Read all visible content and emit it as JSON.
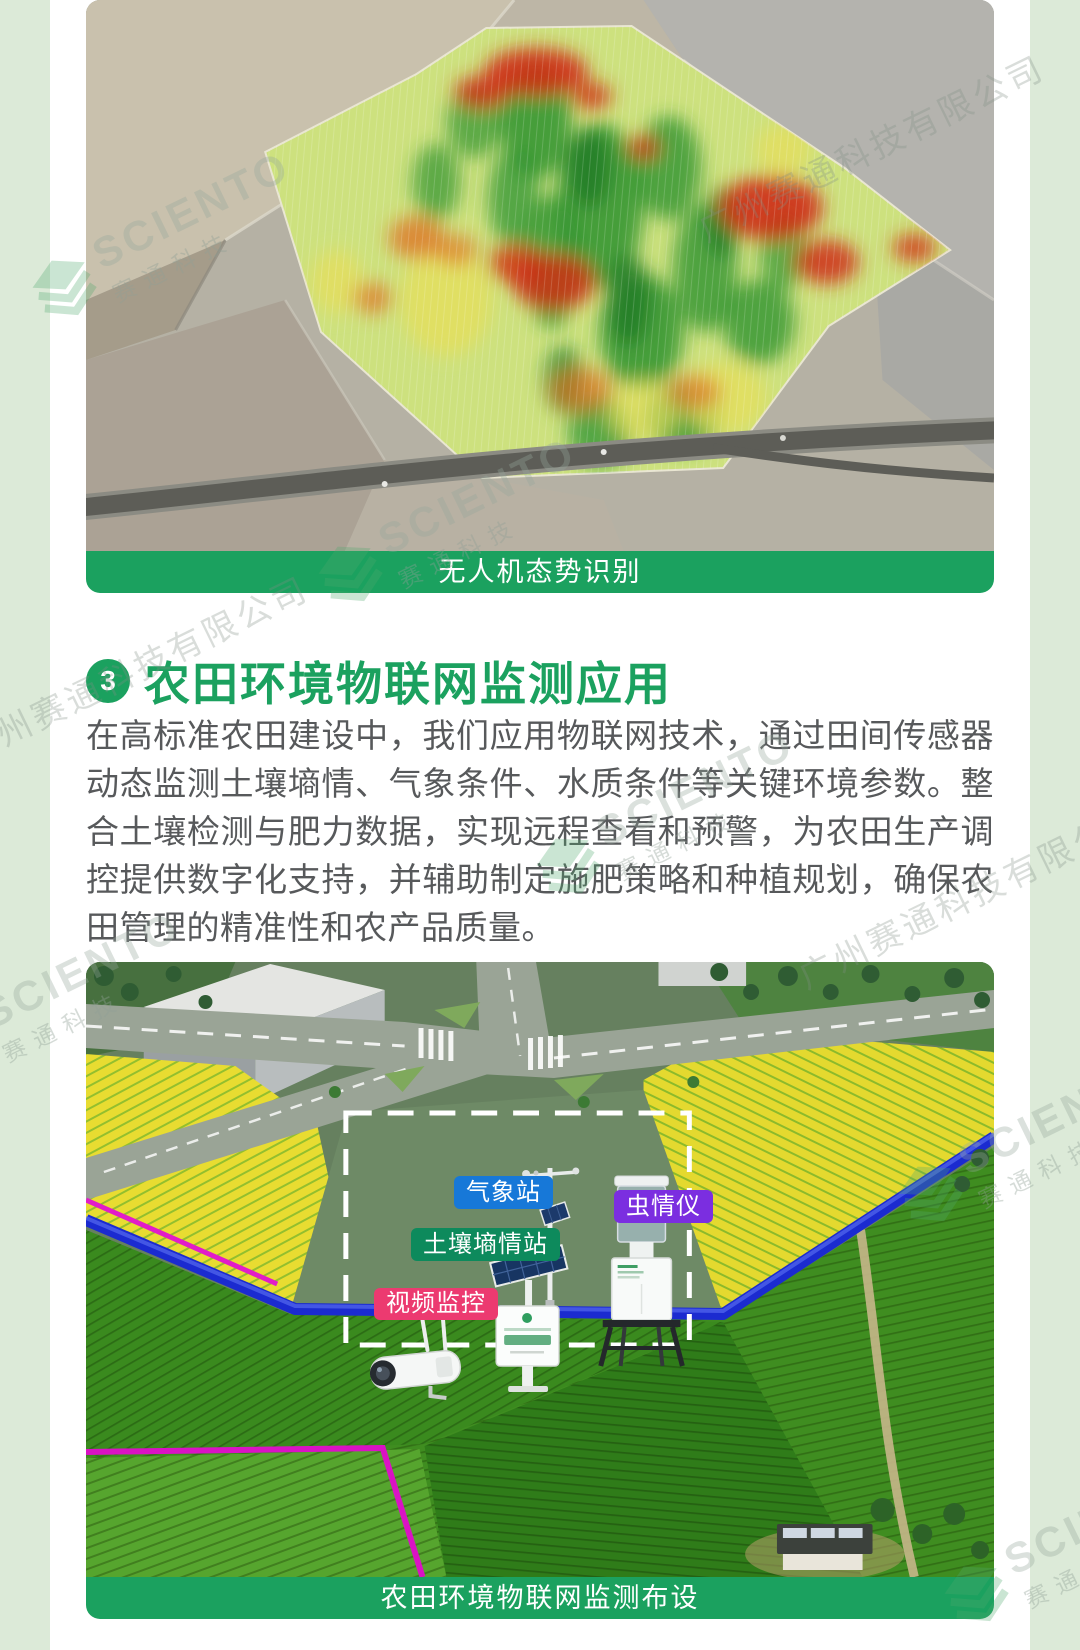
{
  "page": {
    "background": "#dcead8",
    "card_background": "#ffffff",
    "accent_green": "#1ba15f"
  },
  "figure1": {
    "caption": "无人机态势识别"
  },
  "section3": {
    "number": "3",
    "title": "农田环境物联网监测应用",
    "body": "在高标准农田建设中，我们应用物联网技术，通过田间传感器动态监测土壤墒情、气象条件、水质条件等关键环境参数。整合土壤检测与肥力数据，实现远程查看和预警，为农田生产调控提供数字化支持，并辅助制定施肥策略和种植规划，确保农田管理的精准性和农产品质量。"
  },
  "figure2": {
    "caption": "农田环境物联网监测布设",
    "labels": {
      "weather_station": {
        "text": "气象站",
        "color": "#1778d8"
      },
      "insect_monitor": {
        "text": "虫情仪",
        "color": "#7b2ee0"
      },
      "soil_moisture_station": {
        "text": "土壤墒情站",
        "color": "#0d8a5c"
      },
      "video_surveillance": {
        "text": "视频监控",
        "color": "#ec3a70"
      }
    }
  },
  "watermark": {
    "brand_en": "SCIENTO",
    "brand_cn": "赛通科技",
    "company": "广州赛通科技有限公司"
  }
}
